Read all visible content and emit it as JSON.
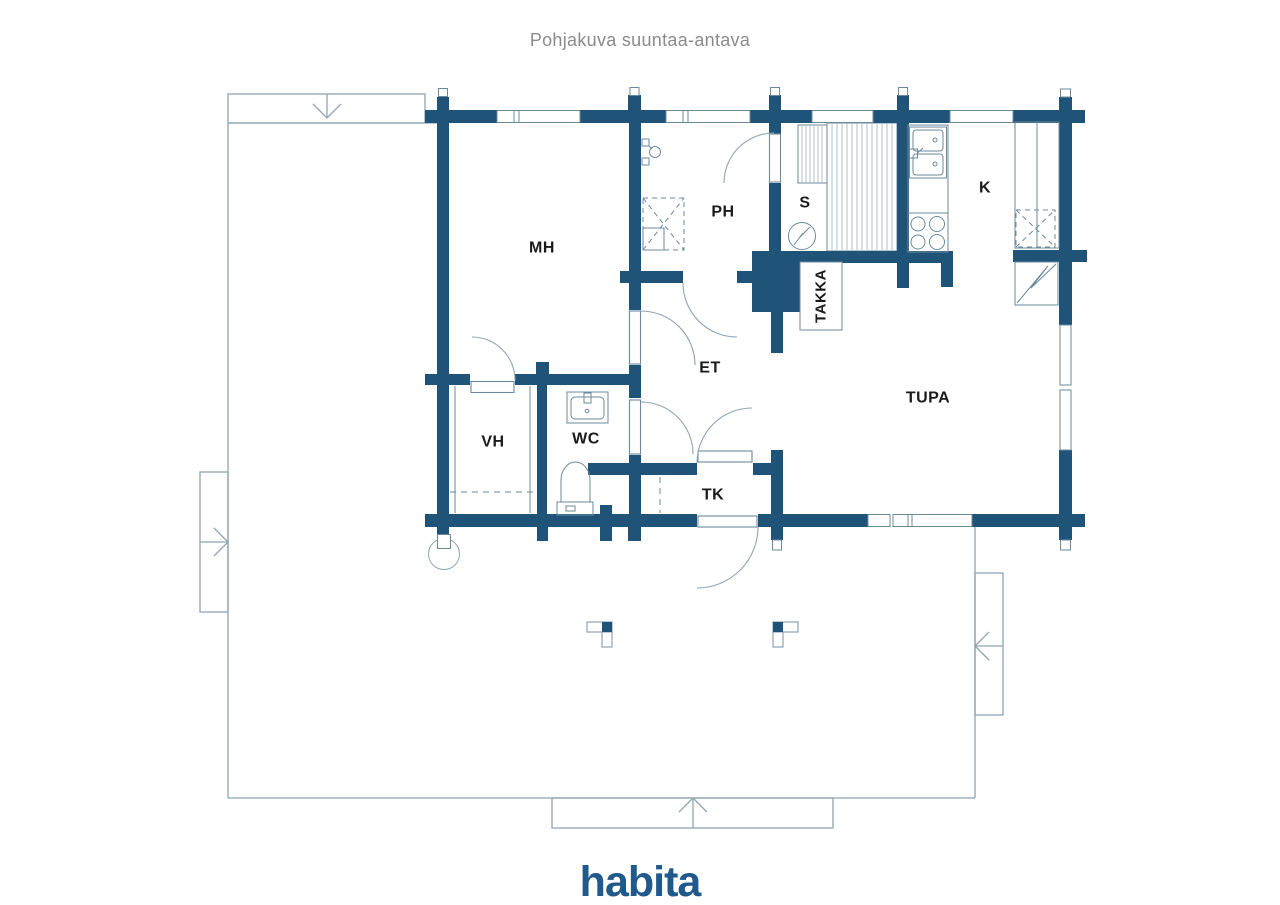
{
  "title": "Pohjakuva suuntaa-antava",
  "logo": "habita",
  "colors": {
    "wall": "#1F5478",
    "terrace_line": "#8FA5B3",
    "fixture_line": "#6C8A9E",
    "label_text": "#1A1A1A",
    "title_text": "#8B8B8B",
    "logo_blue": "#20598B"
  },
  "rooms": [
    {
      "id": "mh",
      "label": "MH"
    },
    {
      "id": "ph",
      "label": "PH"
    },
    {
      "id": "s",
      "label": "S"
    },
    {
      "id": "k",
      "label": "K"
    },
    {
      "id": "takka",
      "label": "TAKKA"
    },
    {
      "id": "et",
      "label": "ET"
    },
    {
      "id": "tupa",
      "label": "TUPA"
    },
    {
      "id": "vh",
      "label": "VH"
    },
    {
      "id": "wc",
      "label": "WC"
    },
    {
      "id": "tk",
      "label": "TK"
    }
  ],
  "symbols": [
    "fireplace",
    "sauna-stove",
    "sauna-benches",
    "kitchen-sink",
    "kitchen-stove",
    "fridge-closet",
    "water-heater",
    "wc-sink",
    "toilet",
    "shower",
    "chimney",
    "terrace-post",
    "stairs-arrow",
    "door-swing",
    "window",
    "log-wall-end"
  ]
}
